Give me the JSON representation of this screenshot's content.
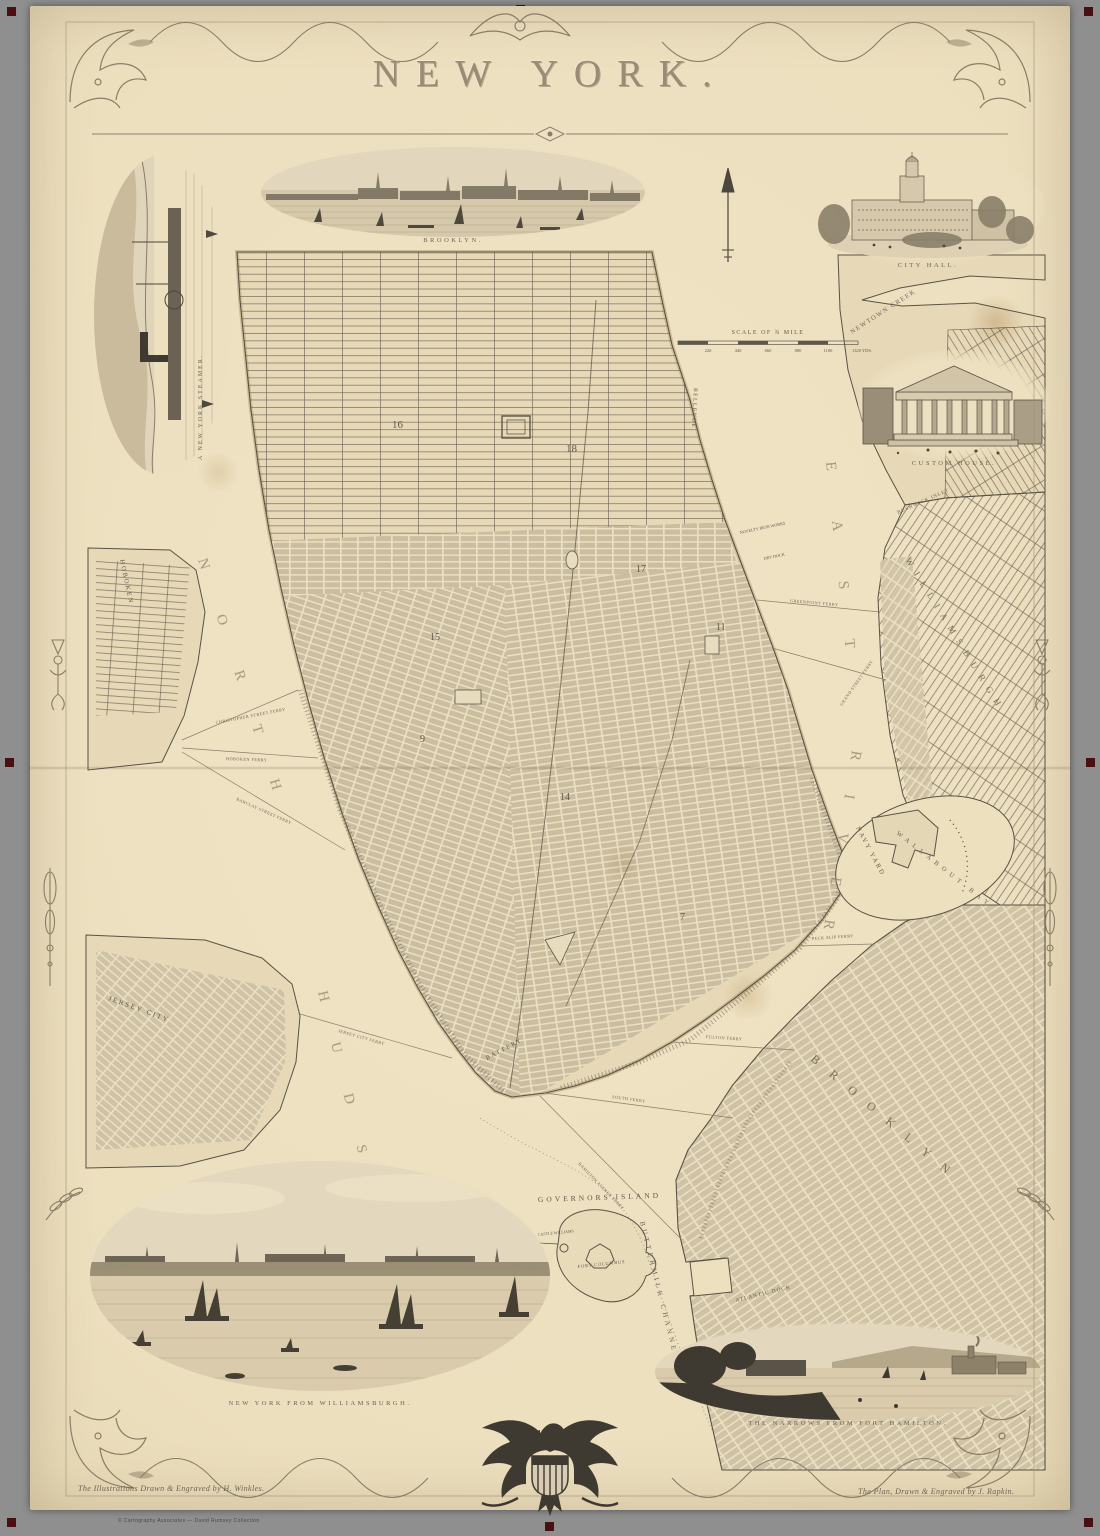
{
  "canvas": {
    "background": "#8f8f8f",
    "paper": "#ece0bf",
    "registration_mark_color": "#4a1011"
  },
  "title": "NEW YORK.",
  "imprint_left": "The Illustrations Drawn & Engraved by H. Winkles.",
  "imprint_right": "The Plan, Drawn & Engraved by J. Rapkin.",
  "footer_micro": "© Cartography Associates — David Rumsey Collection",
  "vignettes": {
    "steamer_caption": "A NEW YORK STEAMER.",
    "brooklyn_caption": "BROOKLYN.",
    "city_hall_caption": "CITY HALL.",
    "custom_house_caption": "CUSTOM HOUSE.",
    "williamsburgh_caption": "NEW YORK FROM WILLIAMSBURGH.",
    "narrows_caption": "THE NARROWS FROM FORT HAMILTON."
  },
  "scale": {
    "caption": "SCALE OF ¾ MILE",
    "ticks": [
      "220",
      "440",
      "660",
      "880",
      "1100",
      "1320 YDS."
    ]
  },
  "water": {
    "north": "NORTH",
    "hudson": "HUDSON",
    "east": "EAST",
    "river": "RIVER",
    "newtown": "NEWTOWN CREEK",
    "bushwick": "BUSHWICK INLET",
    "wallabout": "WALLABOUT BAY",
    "buttermilk": "BUTTERMILK CHANNEL"
  },
  "places": {
    "williamsburgh": "WILLIAMSBURGH",
    "brooklyn": "BROOKLYN",
    "jersey_city": "JERSEY CITY",
    "hoboken": "HOBOKEN",
    "navy_yard": "NAVY YARD",
    "governors_island": "GOVERNORS ISLAND",
    "fort_columbus": "FORT COLUMBUS",
    "castle_williams": "CASTLE WILLIAMS",
    "atlantic_dock": "ATLANTIC DOCK",
    "bellevue": "BELLEVUE",
    "battery": "BATTERY",
    "dry_dock": "DRY DOCK",
    "iron_works": "NOVELTY IRON WORKS"
  },
  "ferries": [
    "CHRISTOPHER STREET FERRY",
    "HOBOKEN FERRY",
    "BARCLAY STREET FERRY",
    "JERSEY CITY FERRY",
    "GREENPOINT FERRY",
    "GRAND STREET FERRY",
    "PECK SLIP FERRY",
    "FULTON FERRY",
    "SOUTH FERRY",
    "HAMILTON AVENUE FERRY"
  ],
  "wards": [
    "16",
    "18",
    "17",
    "15",
    "11",
    "9",
    "14",
    "7"
  ]
}
